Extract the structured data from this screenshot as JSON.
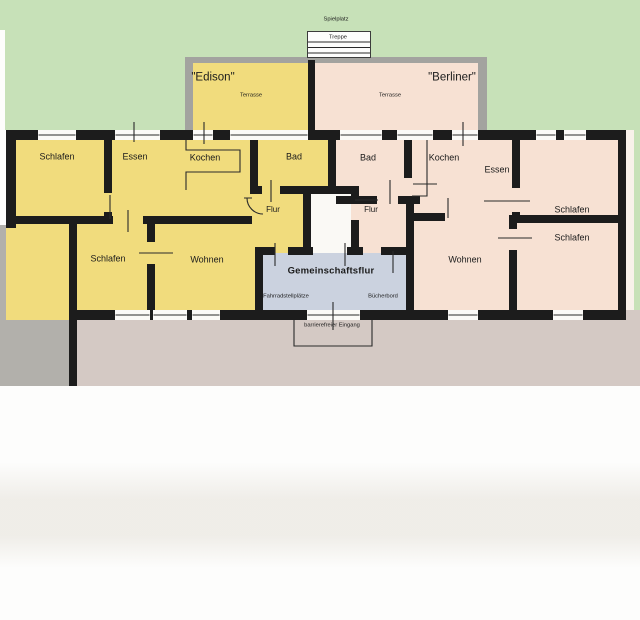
{
  "plan_title": "floor plan of two apartments Edison and Berliner with shared hallway",
  "colors": {
    "green": "#c7e1b8",
    "yellow": "#f1dc7d",
    "pink": "#f7e1d3",
    "blue": "#cbd2df",
    "gray": "#b2b0ab",
    "ground": "#d4c9c4",
    "tgray": "#a3a39f",
    "wall": "#1c1c1c",
    "white": "#fdfdfc",
    "white2": "#faf9f5",
    "palewhite": "#f8f1ea"
  },
  "zones": [
    {
      "name": "lawn-area",
      "x": 0,
      "y": 0,
      "w": 640,
      "h": 130,
      "color": "green"
    },
    {
      "name": "lawn-right-strip",
      "x": 634,
      "y": 130,
      "w": 6,
      "h": 180,
      "color": "green"
    },
    {
      "name": "right-margin",
      "x": 626,
      "y": 130,
      "w": 8,
      "h": 180,
      "color": "palewhite"
    },
    {
      "name": "left-margin",
      "x": 0,
      "y": 30,
      "w": 5,
      "h": 195,
      "color": "white"
    },
    {
      "name": "street-left",
      "x": 0,
      "y": 225,
      "w": 70,
      "h": 161,
      "color": "gray"
    },
    {
      "name": "ground-south",
      "x": 69,
      "y": 310,
      "w": 571,
      "h": 76,
      "color": "ground"
    },
    {
      "name": "terrace-edison-frame",
      "x": 185,
      "y": 57,
      "w": 130,
      "h": 73,
      "color": "tgray"
    },
    {
      "name": "terrace-edison",
      "x": 193,
      "y": 63,
      "w": 117,
      "h": 67,
      "color": "yellow"
    },
    {
      "name": "terrace-divider-wall",
      "x": 308,
      "y": 60,
      "w": 8,
      "h": 70,
      "color": "wall"
    },
    {
      "name": "terrace-berliner-frame",
      "x": 315,
      "y": 57,
      "w": 172,
      "h": 73,
      "color": "tgray"
    },
    {
      "name": "terrace-berliner",
      "x": 315,
      "y": 63,
      "w": 163,
      "h": 67,
      "color": "pink"
    },
    {
      "name": "stair-box",
      "x": 307,
      "y": 31,
      "w": 64,
      "h": 27,
      "color": "white",
      "border": true
    },
    {
      "name": "edison-apartment-area",
      "x": 6,
      "y": 130,
      "w": 326,
      "h": 190,
      "color": "yellow"
    },
    {
      "name": "berliner-apartment-area",
      "x": 332,
      "y": 130,
      "w": 294,
      "h": 190,
      "color": "pink"
    },
    {
      "name": "entry-shaft",
      "x": 311,
      "y": 194,
      "w": 40,
      "h": 61,
      "color": "white2"
    },
    {
      "name": "gemeinschaftsflur-area",
      "x": 263,
      "y": 253,
      "w": 143,
      "h": 57,
      "color": "blue"
    }
  ],
  "walls": [
    [
      6,
      130,
      32,
      10
    ],
    [
      76,
      130,
      39,
      10
    ],
    [
      160,
      130,
      33,
      10
    ],
    [
      213,
      130,
      17,
      10
    ],
    [
      308,
      130,
      32,
      10
    ],
    [
      382,
      130,
      15,
      10
    ],
    [
      433,
      130,
      19,
      10
    ],
    [
      478,
      130,
      58,
      10
    ],
    [
      556,
      130,
      8,
      10
    ],
    [
      586,
      130,
      40,
      10
    ],
    [
      6,
      130,
      10,
      98
    ],
    [
      69,
      216,
      8,
      170
    ],
    [
      6,
      216,
      71,
      8
    ],
    [
      77,
      216,
      36,
      8
    ],
    [
      143,
      216,
      109,
      8
    ],
    [
      104,
      140,
      8,
      53
    ],
    [
      104,
      212,
      8,
      12
    ],
    [
      147,
      224,
      8,
      18
    ],
    [
      147,
      264,
      8,
      48
    ],
    [
      250,
      140,
      8,
      54
    ],
    [
      250,
      186,
      12,
      8
    ],
    [
      280,
      186,
      79,
      8
    ],
    [
      328,
      130,
      8,
      64
    ],
    [
      303,
      194,
      8,
      61
    ],
    [
      351,
      194,
      8,
      6
    ],
    [
      351,
      220,
      8,
      35
    ],
    [
      336,
      196,
      41,
      8
    ],
    [
      398,
      196,
      22,
      8
    ],
    [
      404,
      140,
      8,
      38
    ],
    [
      404,
      196,
      8,
      8
    ],
    [
      406,
      204,
      8,
      108
    ],
    [
      406,
      213,
      39,
      8
    ],
    [
      512,
      140,
      8,
      48
    ],
    [
      512,
      212,
      8,
      11
    ],
    [
      509,
      215,
      117,
      8
    ],
    [
      509,
      223,
      8,
      6
    ],
    [
      509,
      250,
      8,
      62
    ],
    [
      255,
      247,
      8,
      65
    ],
    [
      263,
      247,
      12,
      8
    ],
    [
      288,
      247,
      25,
      8
    ],
    [
      347,
      247,
      16,
      8
    ],
    [
      381,
      247,
      26,
      8
    ],
    [
      618,
      130,
      8,
      190
    ],
    [
      69,
      310,
      46,
      10
    ],
    [
      150,
      310,
      3,
      10
    ],
    [
      187,
      310,
      5,
      10
    ],
    [
      220,
      310,
      87,
      10
    ],
    [
      360,
      310,
      88,
      10
    ],
    [
      478,
      310,
      75,
      10
    ],
    [
      583,
      310,
      43,
      10
    ]
  ],
  "windows": [
    [
      38,
      130,
      38
    ],
    [
      115,
      130,
      45
    ],
    [
      193,
      130,
      20
    ],
    [
      230,
      130,
      78
    ],
    [
      340,
      130,
      42
    ],
    [
      397,
      130,
      36
    ],
    [
      452,
      130,
      26
    ],
    [
      536,
      130,
      20
    ],
    [
      564,
      130,
      22
    ],
    [
      115,
      310,
      35
    ],
    [
      153,
      310,
      34
    ],
    [
      192,
      310,
      28
    ],
    [
      307,
      310,
      53
    ],
    [
      448,
      310,
      30
    ],
    [
      553,
      310,
      30
    ]
  ],
  "details": [
    {
      "name": "kitchen-counter-edison",
      "d": "M186 140 V150 H240 V172 H186 V190"
    },
    {
      "name": "kitchen-counter-berliner",
      "d": "M427 140 V196 H412"
    },
    {
      "name": "door-arc-flur-edison",
      "d": "M244 198 H252 M247 198 A16 16 0 0 0 263 214"
    },
    {
      "name": "entrance-outline",
      "d": "M294 320 V346 H372 V320"
    },
    {
      "name": "stair-treads",
      "d": "M308 42 H370 M308 47.5 H370 M308 53 H370"
    },
    {
      "name": "door-window-ticks",
      "d": "M134 122 V142 M204 122 V144 M463 122 V146 M110 195 V219 M128 210 V232 M271 180 V202 M390 180 V204 M413 184 H437 M355 200 H378 M448 198 V218 M484 201 H530 M498 238 H532 M275 243 V266 M345 243 V266 M393 251 V273 M333 302 V330 M139 253 H173"
    }
  ],
  "labels": [
    {
      "id": "spielplatz",
      "text": "Spielplatz",
      "x": 336,
      "y": 19,
      "cls": "xs"
    },
    {
      "id": "treppe",
      "text": "Treppe",
      "x": 338,
      "y": 37,
      "cls": "xs"
    },
    {
      "id": "edison-name",
      "text": "\"Edison\"",
      "x": 213,
      "y": 78,
      "cls": "m"
    },
    {
      "id": "terrasse-edison",
      "text": "Terrasse",
      "x": 251,
      "y": 95,
      "cls": "xs"
    },
    {
      "id": "berliner-name",
      "text": "\"Berliner\"",
      "x": 452,
      "y": 78,
      "cls": "m"
    },
    {
      "id": "terrasse-berliner",
      "text": "Terrasse",
      "x": 390,
      "y": 95,
      "cls": "xs"
    },
    {
      "id": "schlafen-edison-1",
      "text": "Schlafen",
      "x": 57,
      "y": 157,
      "cls": "s"
    },
    {
      "id": "essen-edison",
      "text": "Essen",
      "x": 135,
      "y": 157,
      "cls": "s"
    },
    {
      "id": "kochen-edison",
      "text": "Kochen",
      "x": 205,
      "y": 158,
      "cls": "s"
    },
    {
      "id": "bad-edison",
      "text": "Bad",
      "x": 294,
      "y": 157,
      "cls": "s"
    },
    {
      "id": "bad-berliner",
      "text": "Bad",
      "x": 368,
      "y": 158,
      "cls": "s"
    },
    {
      "id": "kochen-berliner",
      "text": "Kochen",
      "x": 444,
      "y": 158,
      "cls": "s"
    },
    {
      "id": "essen-berliner",
      "text": "Essen",
      "x": 497,
      "y": 170,
      "cls": "s"
    },
    {
      "id": "schlafen-berliner-1",
      "text": "Schlafen",
      "x": 572,
      "y": 210,
      "cls": "s"
    },
    {
      "id": "schlafen-berliner-2",
      "text": "Schlafen",
      "x": 572,
      "y": 238,
      "cls": "s"
    },
    {
      "id": "flur-edison",
      "text": "Flur",
      "x": 273,
      "y": 210,
      "cls": "s8"
    },
    {
      "id": "flur-berliner",
      "text": "Flur",
      "x": 371,
      "y": 210,
      "cls": "s8"
    },
    {
      "id": "schlafen-edison-2",
      "text": "Schlafen",
      "x": 108,
      "y": 259,
      "cls": "s"
    },
    {
      "id": "wohnen-edison",
      "text": "Wohnen",
      "x": 207,
      "y": 260,
      "cls": "s"
    },
    {
      "id": "wohnen-berliner",
      "text": "Wohnen",
      "x": 465,
      "y": 260,
      "cls": "s"
    },
    {
      "id": "gemeinschaftsflur",
      "text": "Gemeinschaftsflur",
      "x": 331,
      "y": 271,
      "cls": "gf"
    },
    {
      "id": "fahrradstellplaetze",
      "text": "Fahrradstellplätze",
      "x": 286,
      "y": 296,
      "cls": "xs"
    },
    {
      "id": "buecherbord",
      "text": "Bücherbord",
      "x": 383,
      "y": 296,
      "cls": "xs"
    },
    {
      "id": "barrierefreier-eingang",
      "text": "barrierefreier Eingang",
      "x": 332,
      "y": 325,
      "cls": "xs"
    }
  ]
}
